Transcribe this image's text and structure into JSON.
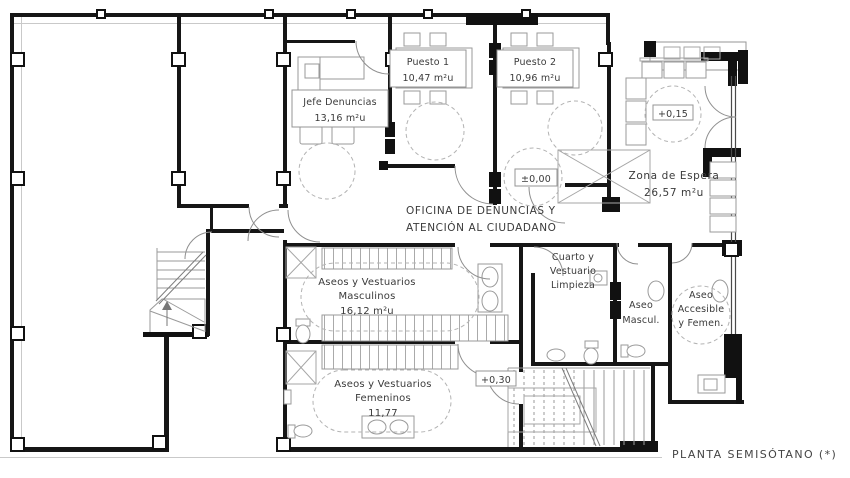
{
  "plan_title": "PLANTA SEMISÓTANO (*)",
  "rooms": {
    "jefe_denuncias": {
      "name": "Jefe Denuncias",
      "area": "13,16 m²u"
    },
    "puesto_1": {
      "name": "Puesto 1",
      "area": "10,47 m²u"
    },
    "puesto_2": {
      "name": "Puesto 2",
      "area": "10,96 m²u"
    },
    "zona_de_espera": {
      "name": "Zona de Espera",
      "area": "26,57 m²u"
    },
    "oficina_denuncias": {
      "line1": "OFICINA DE DENUNCIAS Y",
      "line2": "ATENCIÓN AL CIUDADANO"
    },
    "aseos_vestuarios_masculinos": {
      "line1": "Aseos y Vestuarios",
      "line2": "Masculinos",
      "area": "16,12 m²u"
    },
    "cuarto_vestuario_limpieza": {
      "line1": "Cuarto y",
      "line2": "Vestuario",
      "line3": "Limpieza"
    },
    "aseo_masculino": {
      "line1": "Aseo",
      "line2": "Mascul."
    },
    "aseo_accesible": {
      "line1": "Aseo",
      "line2": "Accesible",
      "line3": "y Femen."
    },
    "aseos_vestuarios_femeninos": {
      "line1": "Aseos y Vestuarios",
      "line2": "Femeninos",
      "area": "11,77"
    }
  },
  "level_markers": {
    "oficina": "±0,00",
    "espera": "+0,15",
    "escalera": "+0,30"
  }
}
